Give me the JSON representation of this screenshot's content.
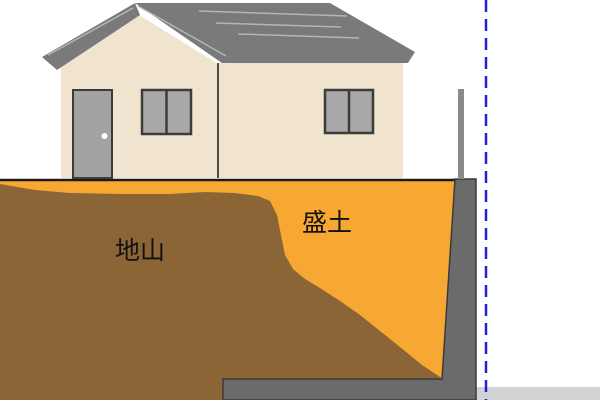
{
  "diagram": {
    "kind": "soil-cross-section-illustration",
    "labels": {
      "natural_ground": "地山",
      "fill_soil": "盛土"
    },
    "colors": {
      "fill_soil": "#f7a833",
      "natural_ground": "#8b6536",
      "roof": "#7a7a7a",
      "roof_highlight": "#b5b5b5",
      "house_wall": "#f0e4ce",
      "door": "#a3a3a3",
      "window": "#a8a8a8",
      "frame_dark": "#3c3c3c",
      "retaining_wall": "#6b6b6b",
      "retaining_wall_outline": "#3a3a3a",
      "fence": "#8a8a8a",
      "lower_ground": "#d2d2d2",
      "boundary_line": "#2222d8",
      "ground_line": "#1a1a1a",
      "label_text": "#111111"
    }
  }
}
